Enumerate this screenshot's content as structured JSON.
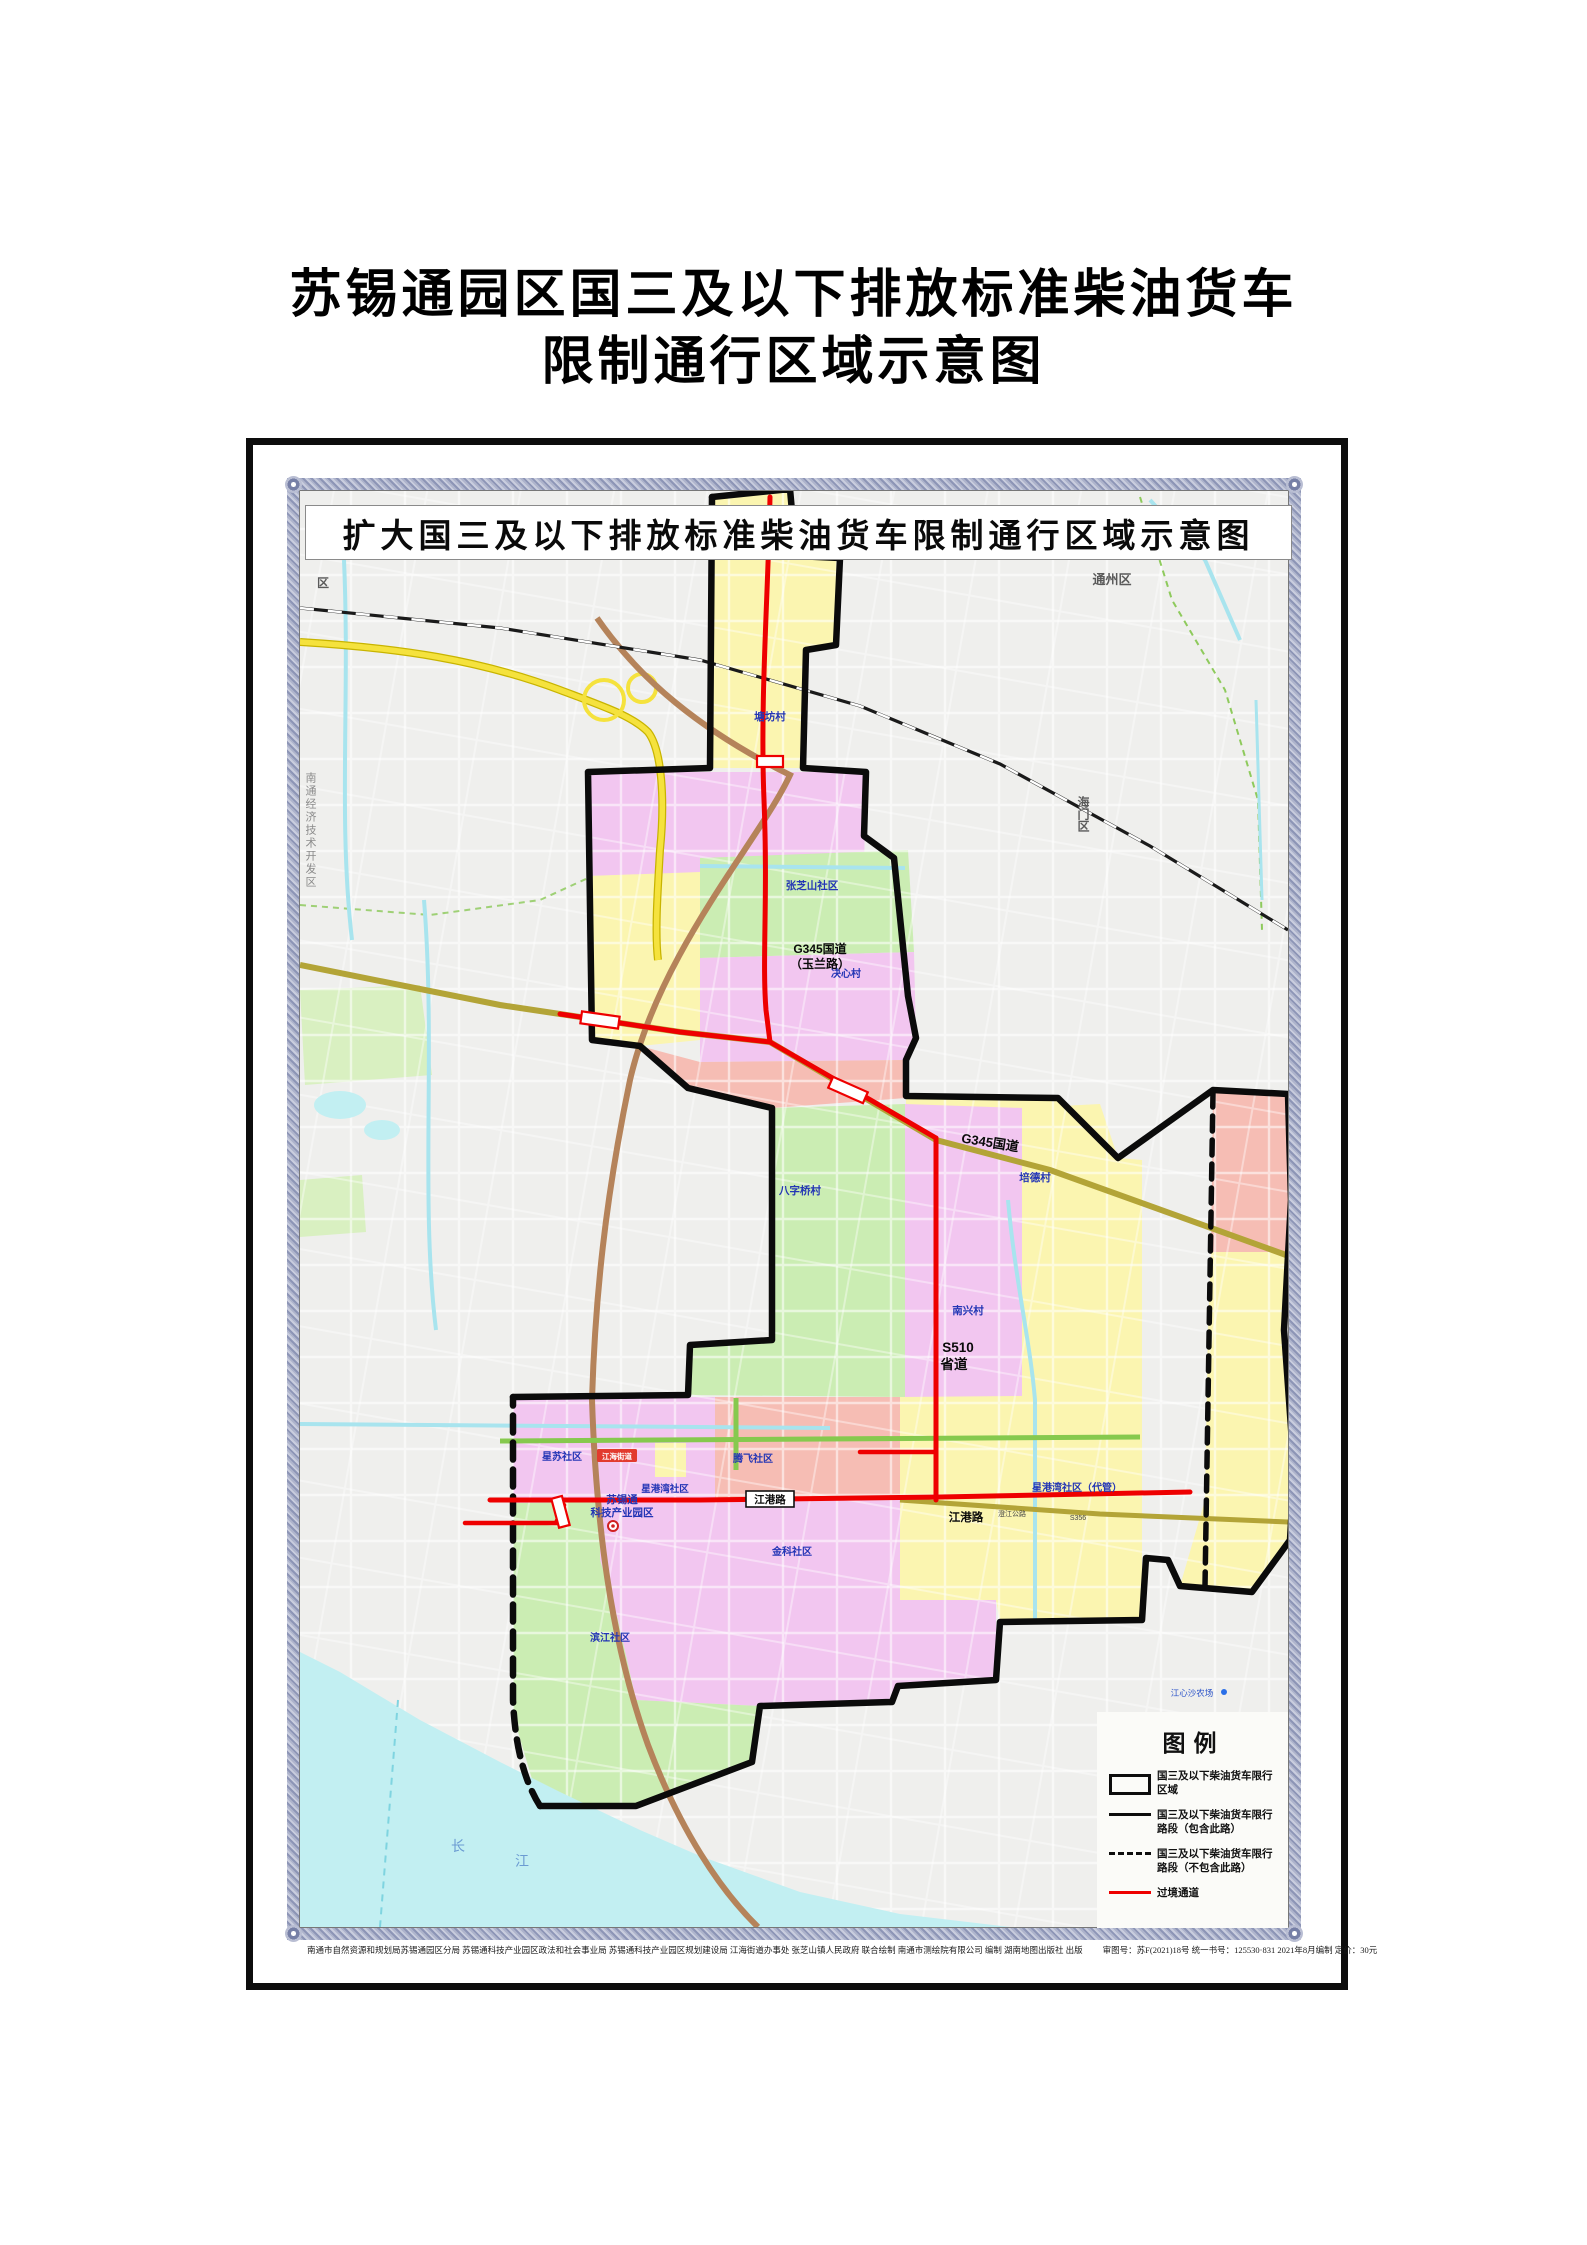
{
  "page": {
    "title_line1": "苏锡通园区国三及以下排放标准柴油货车",
    "title_line2": "限制通行区域示意图"
  },
  "map": {
    "banner_title": "扩大国三及以下排放标准柴油货车限制通行区域示意图",
    "labels": {
      "tangfangcun": "塘坊村",
      "zhangzhishan_shequ": "张芝山社区",
      "g345_yulan_1": "G345国道",
      "g345_yulan_2": "（玉兰路）",
      "juexincun": "决心村",
      "baziqiaocun": "八字桥村",
      "nanxingcun": "南兴村",
      "peidecun": "培德村",
      "g345": "G345国道",
      "s510": "S510",
      "shengdao": "省道",
      "xingsu": "星苏社区",
      "tengfei": "腾飞社区",
      "xingganwan": "星港湾社区",
      "xingganwan_daiguan": "星港湾社区（代管）",
      "jinke": "金科社区",
      "binjiang": "滨江社区",
      "sxt_1": "苏锡通",
      "sxt_2": "科技产业园区",
      "jianggang_lu": "江港路",
      "jianghai_jiedao": "江海街道",
      "chang": "长",
      "jiang": "江",
      "jiangxinsha": "江心沙农场",
      "tongzhou_qu": "通州区",
      "haimen_qu": "海门区",
      "qu": "区",
      "kaifaqu": "南通经济技术开发区",
      "chengjiang_gonglu": "澄江公路",
      "s356": "S356"
    }
  },
  "legend": {
    "title": "图例",
    "items": [
      {
        "symbol": "black-rect-outline",
        "label": "国三及以下柴油货车限行区域"
      },
      {
        "symbol": "black-solid-line",
        "label": "国三及以下柴油货车限行路段（包含此路）"
      },
      {
        "symbol": "black-dashed-line",
        "label": "国三及以下柴油货车限行路段（不包含此路）"
      },
      {
        "symbol": "red-solid-line",
        "label": "过境通道"
      }
    ]
  },
  "credits": {
    "left": "南通市自然资源和规划局苏锡通园区分局  苏锡通科技产业园区政法和社会事业局  苏锡通科技产业园区规划建设局  江海街道办事处  张芝山镇人民政府  联合绘制    南通市测绘院有限公司  编制    湖南地图出版社  出版",
    "right": "审图号：苏F(2021)18号  统一书号：125530·831  2021年8月编制  定价：30元"
  },
  "colors": {
    "zone_yellow": "#FBF5B0",
    "zone_magenta": "#F2C6F0",
    "zone_green": "#CBEDB3",
    "zone_salmon": "#F6BDB4",
    "water_cyan": "#C2EFF2",
    "transit_red": "#EE0000",
    "boundary_black": "#0B0B0B",
    "label_blue": "#2335B5",
    "highway_yellow": "#F5E23D",
    "road_olive": "#B3A437",
    "road_brown": "#B5835A",
    "ornament_border": "#AEB4CC"
  }
}
